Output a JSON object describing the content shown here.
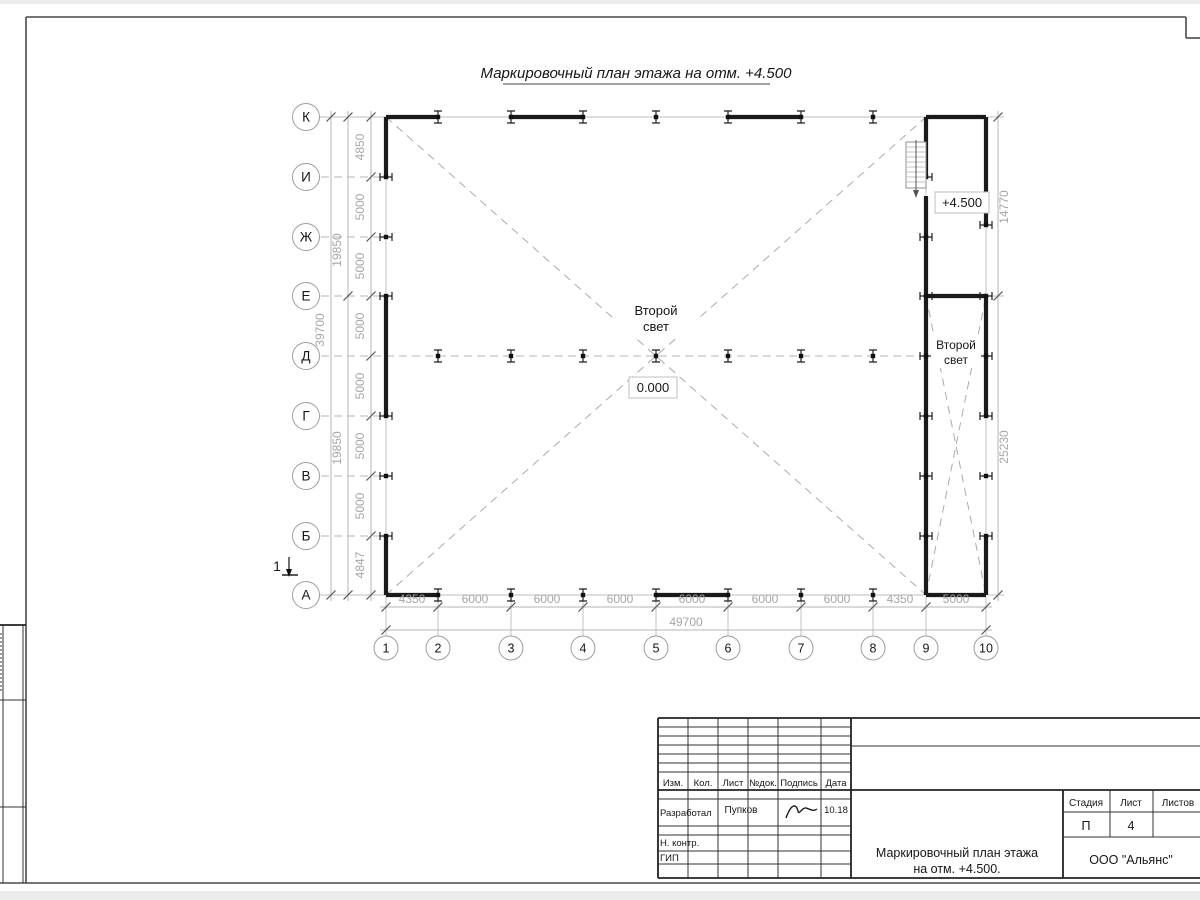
{
  "drawing_title": "Маркировочный план этажа на отм. +4.500",
  "plan": {
    "row_labels": [
      "К",
      "И",
      "Ж",
      "Е",
      "Д",
      "Г",
      "В",
      "Б",
      "А"
    ],
    "col_labels": [
      "1",
      "2",
      "3",
      "4",
      "5",
      "6",
      "7",
      "8",
      "9",
      "10"
    ],
    "bottom_dims": [
      "4350",
      "6000",
      "6000",
      "6000",
      "6000",
      "6000",
      "6000",
      "4350",
      "5000"
    ],
    "bottom_total": "49700",
    "left_dims": [
      "4850",
      "5000",
      "5000",
      "5000",
      "5000",
      "5000",
      "5000",
      "4847"
    ],
    "left_mid_dims": [
      "19850",
      "19850"
    ],
    "left_total": "39700",
    "right_dims": [
      "14770",
      "25230"
    ],
    "second_light_line1": "Второй",
    "second_light_line2": "свет",
    "level_zero": "0.000",
    "level_upper": "+4.500",
    "section_mark": "1"
  },
  "title_block": {
    "col_headers": [
      "Изм.",
      "Кол.",
      "Лист",
      "№док.",
      "Подпись",
      "Дата"
    ],
    "developed_label": "Разработал",
    "developed_name": "Пупков",
    "date": "10.18",
    "norm_control_label": "Н. контр.",
    "gip_label": "ГИП",
    "stage_label": "Стадия",
    "sheet_label": "Лист",
    "sheets_label": "Листов",
    "stage_value": "П",
    "sheet_value": "4",
    "doc_title_line1": "Маркировочный план этажа",
    "doc_title_line2": "на отм. +4.500.",
    "company": "ООО \"Альянс\""
  },
  "colors": {
    "wall": "#1a1a1a",
    "dim_text": "#a6a6a6",
    "grid_line": "#bdbdbd",
    "frame": "#4a4a4a",
    "paper": "#ffffff",
    "background": "#ebebeb"
  }
}
